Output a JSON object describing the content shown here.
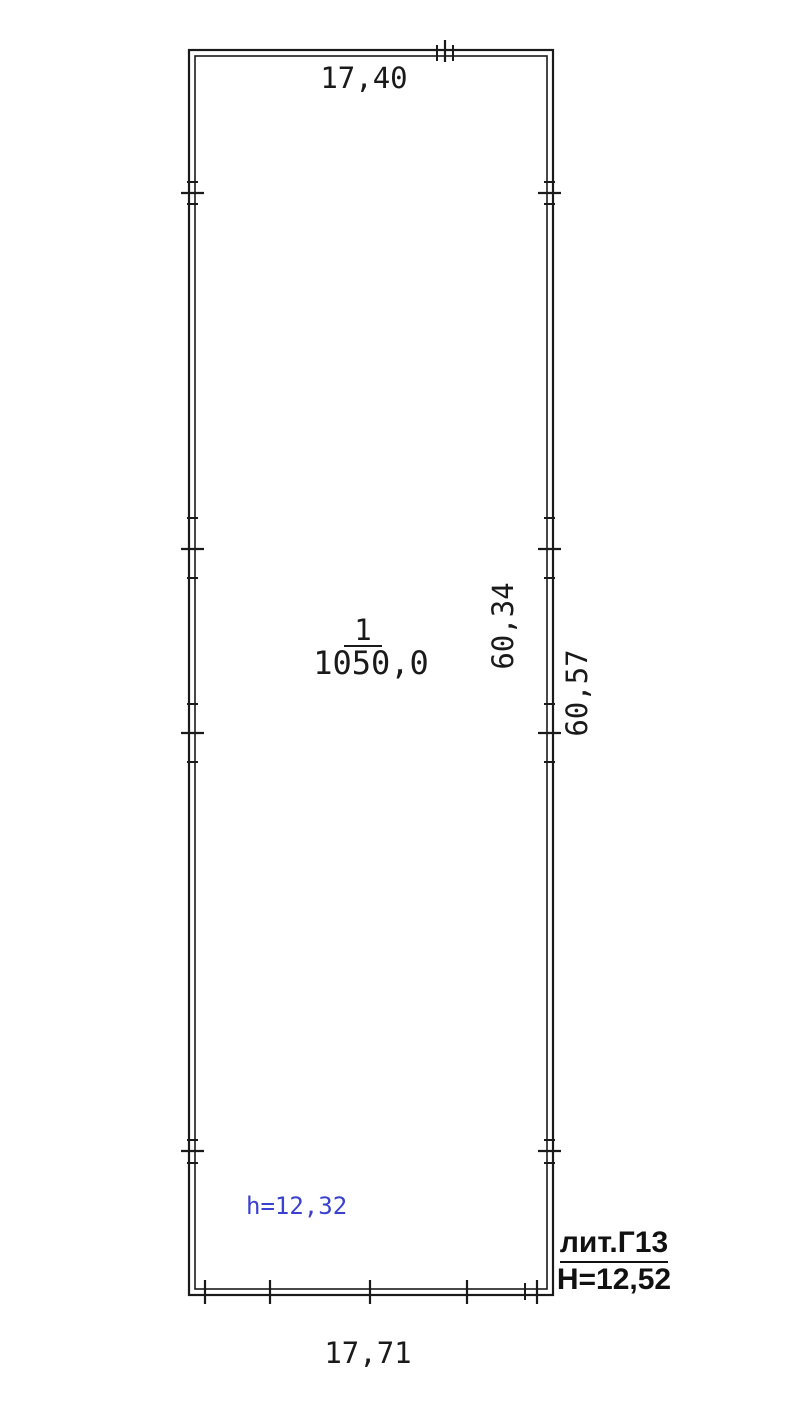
{
  "plan": {
    "type": "floor-plan",
    "background": "#ffffff",
    "ink": "#1a1a1a",
    "accent_blue": "#3a41cf",
    "labels": {
      "top_width": "17,40",
      "bottom_width": "17,71",
      "side_inner": "60,34",
      "side_outer": "60,57",
      "room_number": "1",
      "room_area": "1050,0",
      "ceiling_height": "h=12,32",
      "liter": "лит.Г13",
      "building_height": "Н=12,52"
    },
    "geometry": {
      "outer": {
        "x": 189,
        "y": 50,
        "w": 364,
        "h": 1245
      },
      "inner": {
        "x": 195,
        "y": 56,
        "w": 352,
        "h": 1233
      },
      "ticks": {
        "left_y": [
          193,
          549,
          733,
          1151
        ],
        "right_y": [
          193,
          549,
          733,
          1151
        ],
        "top_x": [
          445
        ],
        "bottom_x": [
          205,
          270,
          370,
          467,
          537
        ],
        "left_minor_y": [
          182,
          204,
          518,
          578,
          704,
          762,
          1140,
          1163
        ],
        "right_minor_y": [
          182,
          204,
          518,
          578,
          704,
          762,
          1140,
          1163
        ],
        "top_minor_x": [
          437,
          453
        ],
        "bottom_minor_x": [
          525
        ]
      }
    }
  }
}
